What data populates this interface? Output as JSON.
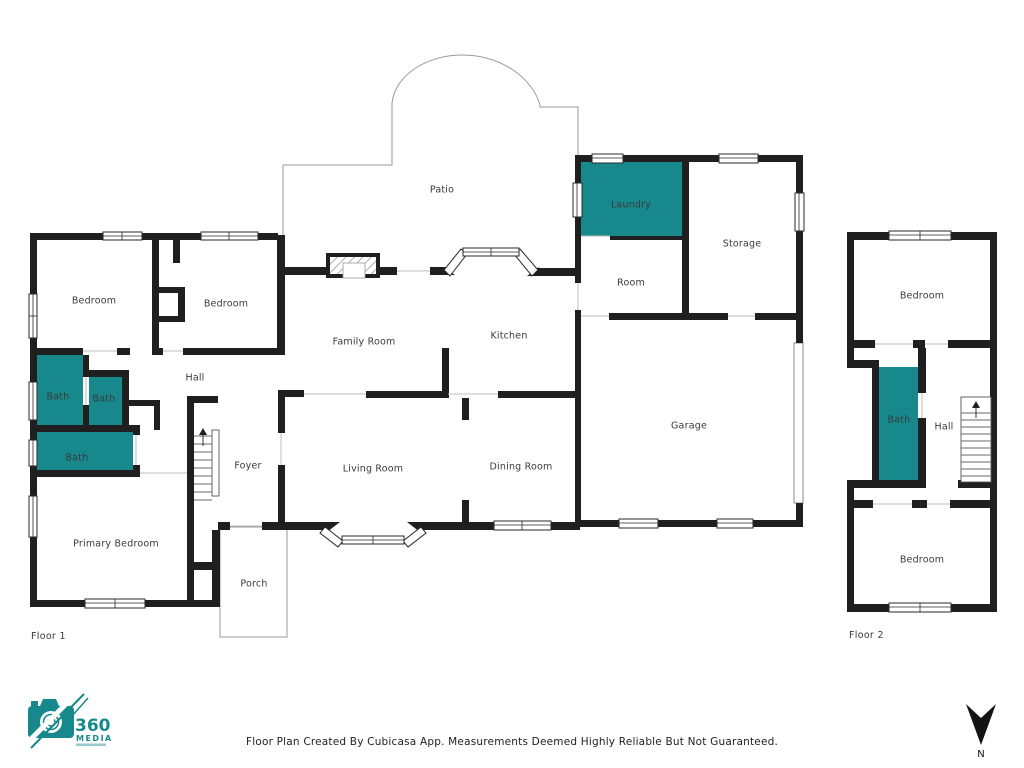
{
  "floors": {
    "floor1": {
      "label": "Floor 1",
      "rooms": {
        "patio": "Patio",
        "laundry": "Laundry",
        "storage": "Storage",
        "room": "Room",
        "bedroom_a": "Bedroom",
        "bedroom_b": "Bedroom",
        "family_room": "Family Room",
        "kitchen": "Kitchen",
        "hall": "Hall",
        "bath_a": "Bath",
        "bath_b": "Bath",
        "bath_c": "Bath",
        "foyer": "Foyer",
        "living_room": "Living Room",
        "dining_room": "Dining Room",
        "garage": "Garage",
        "primary_bedroom": "Primary Bedroom",
        "porch": "Porch"
      }
    },
    "floor2": {
      "label": "Floor 2",
      "rooms": {
        "bedroom_top": "Bedroom",
        "bath": "Bath",
        "hall": "Hall",
        "bedroom_bottom": "Bedroom"
      }
    }
  },
  "footer": {
    "disclaimer": "Floor Plan Created By Cubicasa App. Measurements Deemed Highly Reliable But Not Guaranteed."
  },
  "logo": {
    "number": "360",
    "name": "MEDIA"
  },
  "compass": {
    "label": "N"
  },
  "colors": {
    "highlight": "#17898D",
    "wall": "#1F1F1F",
    "outline": "#9A9A9A"
  }
}
